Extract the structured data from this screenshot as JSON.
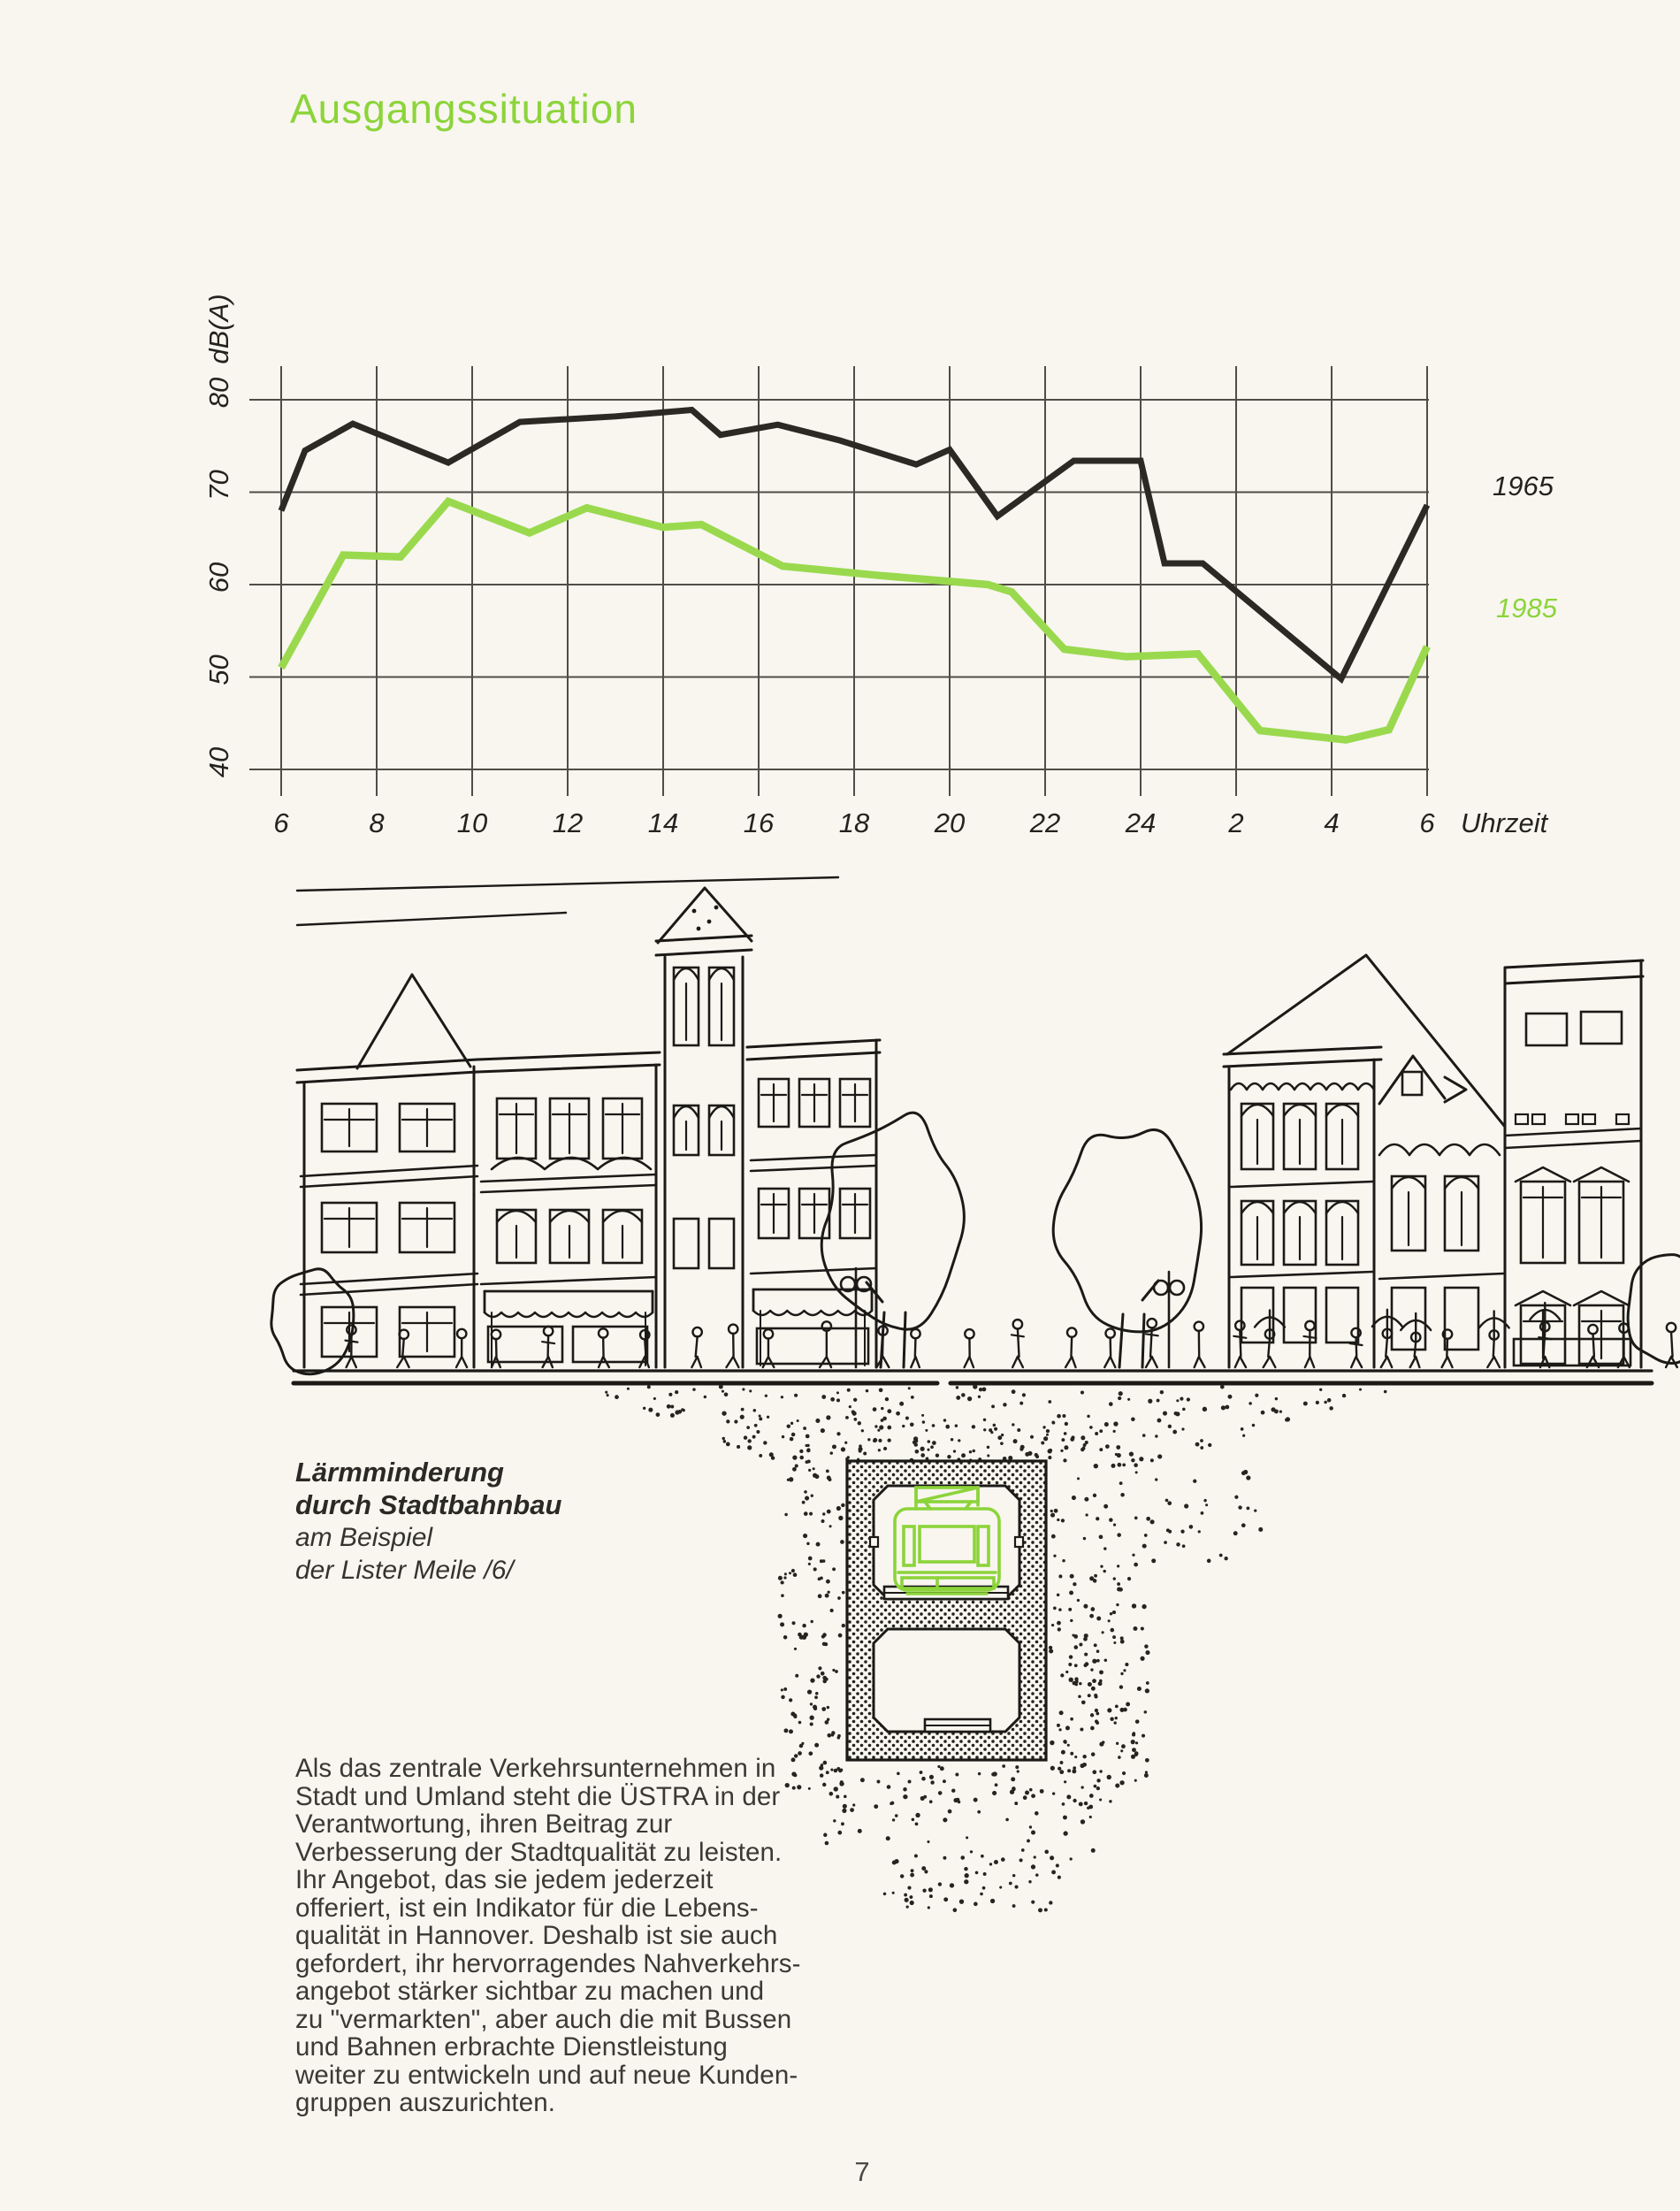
{
  "header": {
    "title": "Ausgangssituation"
  },
  "page": {
    "paper_color": "#f8f6ef",
    "accent_green": "#8cd43a",
    "ink": "#1b1a17"
  },
  "chart_data": {
    "type": "line",
    "title": "",
    "ylabel": "dB(A)",
    "xlabel": "Uhrzeit",
    "ylim": [
      40,
      80
    ],
    "grid": true,
    "legend_position": "right",
    "y_ticks": [
      80,
      70,
      60,
      50,
      40
    ],
    "x_tick_hours": [
      6,
      8,
      10,
      12,
      14,
      16,
      18,
      20,
      22,
      24,
      26,
      28,
      30
    ],
    "x_tick_labels": [
      "6",
      "8",
      "10",
      "12",
      "14",
      "16",
      "18",
      "20",
      "22",
      "24",
      "2",
      "4",
      "6"
    ],
    "series": [
      {
        "name": "1965",
        "color": "#2c2824",
        "points": [
          [
            6,
            68
          ],
          [
            6.5,
            74.5
          ],
          [
            7.5,
            77.4
          ],
          [
            9.5,
            73.2
          ],
          [
            11,
            77.6
          ],
          [
            13,
            78.2
          ],
          [
            14.6,
            78.9
          ],
          [
            15.2,
            76.2
          ],
          [
            16.4,
            77.3
          ],
          [
            17.7,
            75.6
          ],
          [
            19.3,
            73.0
          ],
          [
            20,
            74.6
          ],
          [
            21,
            67.4
          ],
          [
            22.6,
            73.4
          ],
          [
            24,
            73.4
          ],
          [
            24.5,
            62.3
          ],
          [
            25.3,
            62.3
          ],
          [
            28.2,
            49.8
          ],
          [
            30,
            68.6
          ]
        ]
      },
      {
        "name": "1985",
        "color": "#9ad94e",
        "points": [
          [
            6,
            51
          ],
          [
            7.3,
            63.2
          ],
          [
            8.5,
            63
          ],
          [
            9.5,
            69
          ],
          [
            11.2,
            65.6
          ],
          [
            12.4,
            68.3
          ],
          [
            14,
            66.2
          ],
          [
            14.8,
            66.5
          ],
          [
            16.5,
            62
          ],
          [
            18.5,
            61
          ],
          [
            20.8,
            60
          ],
          [
            21.3,
            59.2
          ],
          [
            22.4,
            53
          ],
          [
            23.7,
            52.2
          ],
          [
            25.2,
            52.5
          ],
          [
            26.5,
            44.2
          ],
          [
            28.3,
            43.2
          ],
          [
            29.2,
            44.3
          ],
          [
            30,
            53.3
          ]
        ]
      }
    ]
  },
  "caption": {
    "line1": "Lärmminderung",
    "line2": "durch Stadtbahnbau",
    "line3": "am Beispiel",
    "line4": "der Lister Meile /6/"
  },
  "body": {
    "lines": [
      "Als das zentrale Verkehrsunternehmen in",
      "Stadt und Umland steht die ÜSTRA in der",
      "Verantwortung, ihren Beitrag zur",
      "Verbesserung der Stadtqualität zu leisten.",
      "Ihr Angebot, das sie jedem jederzeit",
      "offeriert, ist ein Indikator für die Lebens-",
      "qualität in Hannover. Deshalb ist sie auch",
      "gefordert, ihr hervorragendes Nahverkehrs-",
      "angebot stärker sichtbar zu machen und",
      "zu \"vermarkten\", aber auch die mit Bussen",
      "und Bahnen erbrachte Dienstleistung",
      "weiter zu entwickeln und auf neue Kunden-",
      "gruppen auszurichten."
    ]
  },
  "footer": {
    "page_number": "7"
  }
}
